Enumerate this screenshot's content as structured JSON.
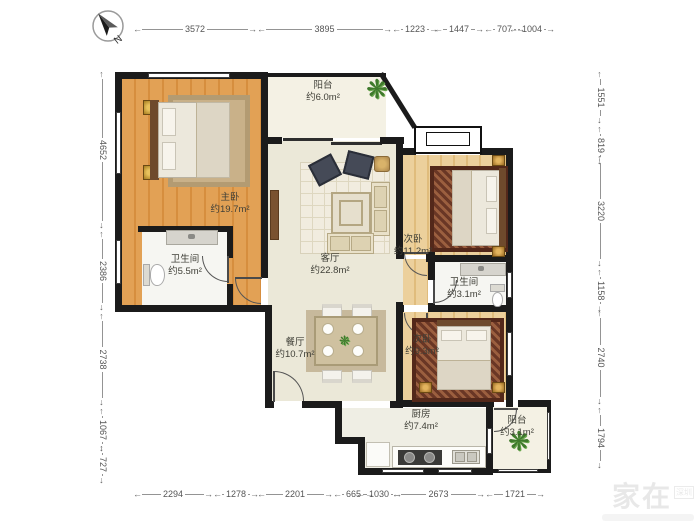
{
  "compass": {
    "north": "N"
  },
  "rooms": {
    "balcony_top": {
      "name": "阳台",
      "area": "约6.0m²"
    },
    "master": {
      "name": "主卧",
      "area": "约19.7m²"
    },
    "living": {
      "name": "客厅",
      "area": "约22.8m²"
    },
    "bed2": {
      "name": "次卧",
      "area": "约11.2m²"
    },
    "bath1": {
      "name": "卫生间",
      "area": "约5.5m²"
    },
    "bath2": {
      "name": "卫生间",
      "area": "约3.1m²"
    },
    "dining": {
      "name": "餐厅",
      "area": "约10.7m²"
    },
    "bed3": {
      "name": "次卧",
      "area": "约9.3m²"
    },
    "kitchen": {
      "name": "厨房",
      "area": "约7.4m²"
    },
    "balcony_bottom": {
      "name": "阳台",
      "area": "约3.1m²"
    }
  },
  "dimensions": {
    "top": [
      "3572",
      "3895",
      "1223",
      "1447",
      "707",
      "1004"
    ],
    "bottom": [
      "2294",
      "1278",
      "2201",
      "665",
      "1030",
      "2673",
      "1721"
    ],
    "left": [
      "4652",
      "2386",
      "2738",
      "1067",
      "727"
    ],
    "right": [
      "1551",
      "819",
      "3220",
      "1158",
      "2740",
      "1794"
    ]
  },
  "watermark": {
    "brand": "家在",
    "region": "深圳"
  },
  "icons": {
    "plant": "❋"
  },
  "colors": {
    "wall": "#1b1b1b",
    "wood_master": "#e2a155",
    "wood_bedroom": "#ecd09c",
    "floor_living": "#ebe8d8",
    "floor_bath": "#f6f6f2",
    "rug_dark": "#8a4a33",
    "plant_green": "#3f7a2c",
    "dimension_text": "#555555"
  }
}
